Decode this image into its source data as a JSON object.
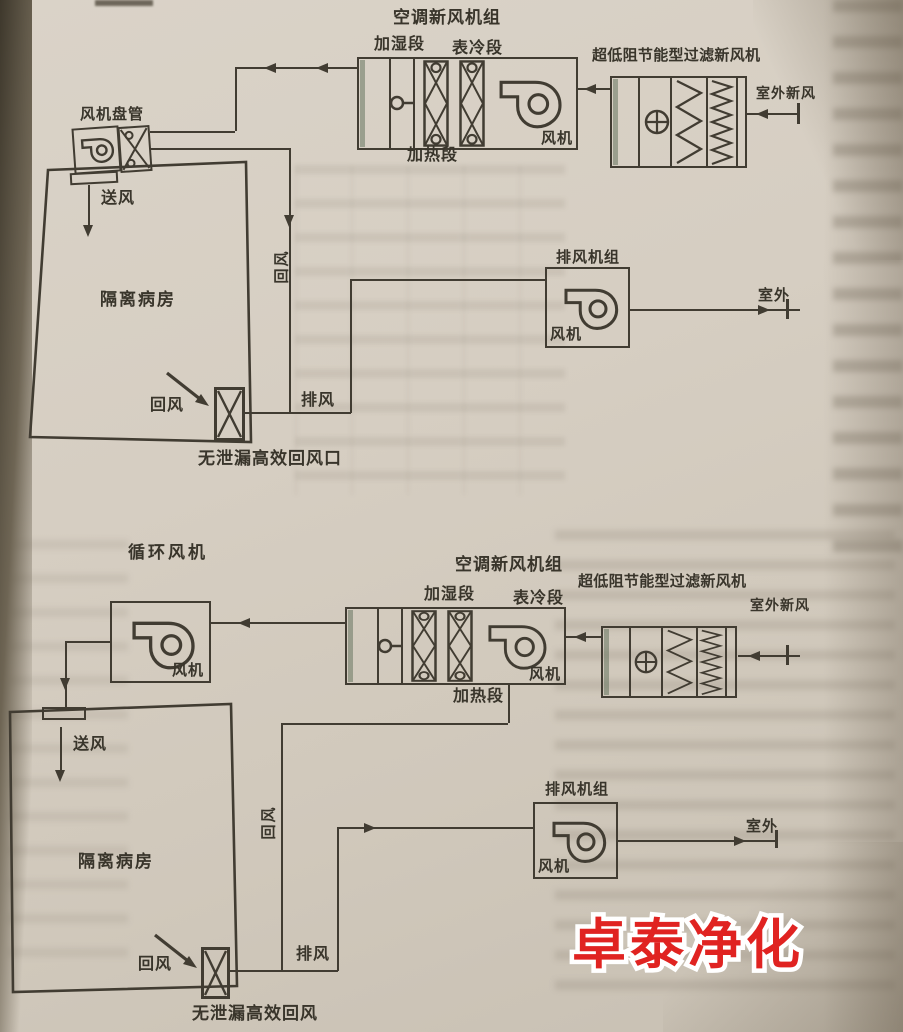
{
  "watermark": {
    "text": "卓泰净化",
    "color": "#e02321"
  },
  "top_diagram": {
    "ahu_title": "空调新风机组",
    "humidifier_section": "加湿段",
    "cooling_section": "表冷段",
    "heating_section": "加热段",
    "ahu_fan": "风机",
    "filter_unit_title": "超低阻节能型过滤新风机",
    "outdoor_fresh_air": "室外新风",
    "fan_coil_title": "风机盘管",
    "supply_air": "送风",
    "room": "隔离病房",
    "return_air": "回风",
    "return_duct": "回风",
    "exhaust_air": "排风",
    "return_outlet": "无泄漏高效回风口",
    "exhaust_unit_title": "排风机组",
    "exhaust_fan": "风机",
    "outdoor": "室外"
  },
  "bottom_diagram": {
    "circulation_fan_title": "循环风机",
    "circulation_fan": "风机",
    "ahu_title": "空调新风机组",
    "humidifier_section": "加湿段",
    "cooling_section": "表冷段",
    "heating_section": "加热段",
    "ahu_fan": "风机",
    "filter_unit_title": "超低阻节能型过滤新风机",
    "outdoor_fresh_air": "室外新风",
    "supply_air": "送风",
    "room": "隔离病房",
    "return_air": "回风",
    "return_duct": "回风",
    "exhaust_air": "排风",
    "return_outlet": "无泄漏高效回风",
    "exhaust_unit_title": "排风机组",
    "exhaust_fan": "风机",
    "outdoor": "室外"
  }
}
